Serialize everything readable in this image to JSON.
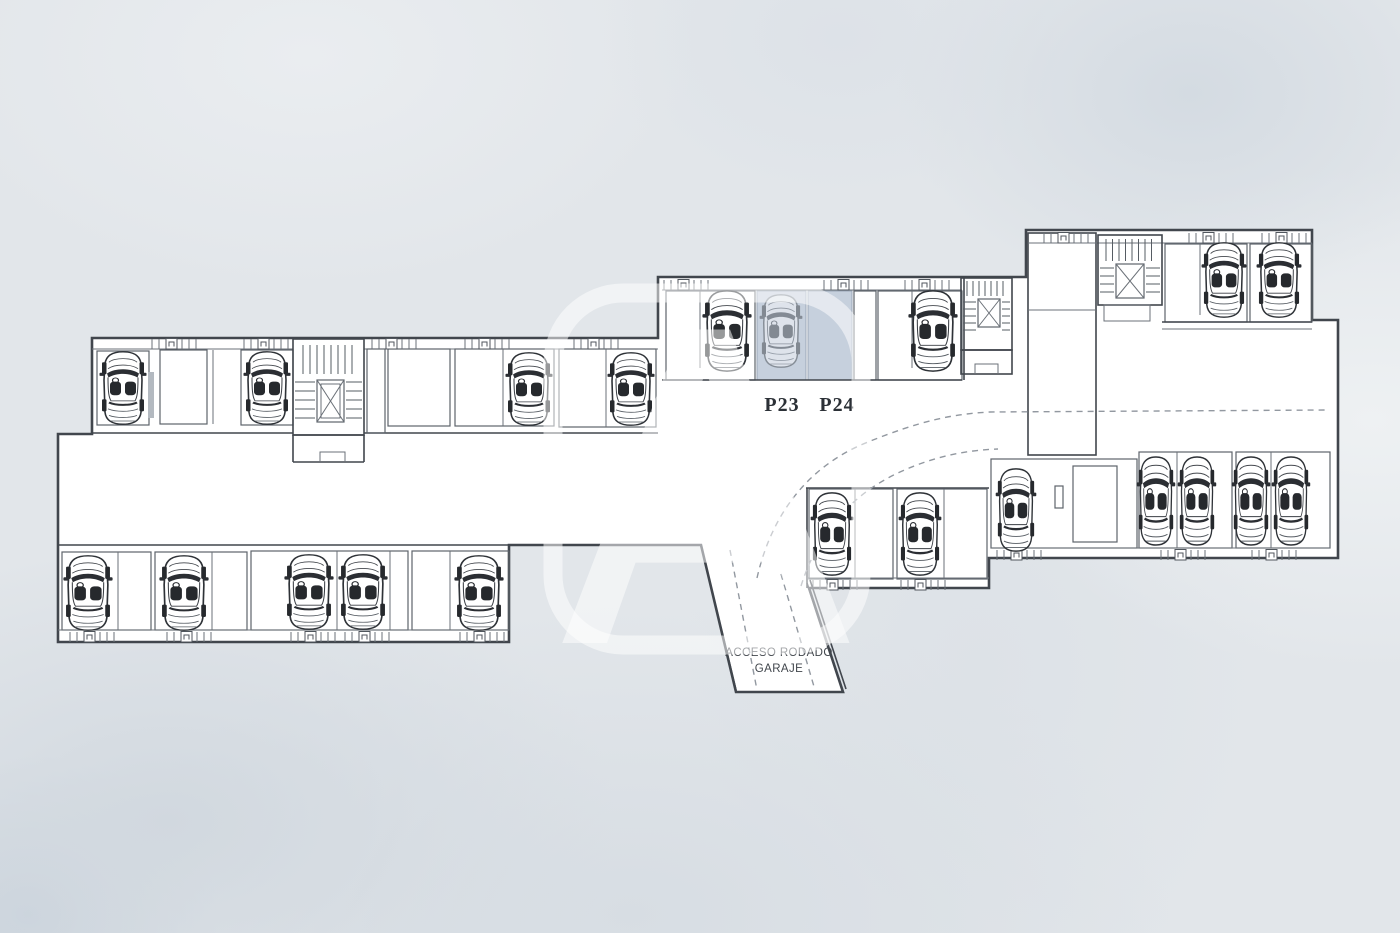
{
  "plan": {
    "stall_labels": {
      "p23": "P23",
      "p24": "P24"
    },
    "ramp": {
      "line1": "ACCESO RODADO",
      "line2": "GARAJE"
    },
    "watermark_letter": "A",
    "colors": {
      "background": "#e2e6ea",
      "wall": "#41464d",
      "highlight": "#c6d0dd",
      "dash": "#9298a0",
      "floor": "#ffffff"
    },
    "icons": {
      "car": "top-view-car-icon",
      "elevator": "elevator-x-icon",
      "stairs": "stair-treads-icon",
      "door": "storage-door-icon"
    },
    "cars": [
      {
        "x": 123,
        "y": 351,
        "w": 44,
        "h": 74
      },
      {
        "x": 267,
        "y": 351,
        "w": 44,
        "h": 74
      },
      {
        "x": 529,
        "y": 352,
        "w": 44,
        "h": 74
      },
      {
        "x": 631,
        "y": 352,
        "w": 44,
        "h": 74
      },
      {
        "x": 727,
        "y": 290,
        "w": 46,
        "h": 82
      },
      {
        "x": 781,
        "y": 294,
        "w": 40,
        "h": 74,
        "ghost": true
      },
      {
        "x": 933,
        "y": 290,
        "w": 46,
        "h": 82
      },
      {
        "x": 1224,
        "y": 242,
        "w": 42,
        "h": 76
      },
      {
        "x": 1279,
        "y": 242,
        "w": 42,
        "h": 76
      },
      {
        "x": 88,
        "y": 555,
        "w": 46,
        "h": 76
      },
      {
        "x": 184,
        "y": 555,
        "w": 46,
        "h": 76
      },
      {
        "x": 309,
        "y": 554,
        "w": 46,
        "h": 76
      },
      {
        "x": 363,
        "y": 554,
        "w": 46,
        "h": 76
      },
      {
        "x": 479,
        "y": 555,
        "w": 46,
        "h": 76
      },
      {
        "x": 832,
        "y": 492,
        "w": 40,
        "h": 84
      },
      {
        "x": 920,
        "y": 492,
        "w": 40,
        "h": 84
      },
      {
        "x": 1016,
        "y": 468,
        "w": 38,
        "h": 84
      },
      {
        "x": 1156,
        "y": 456,
        "w": 36,
        "h": 90
      },
      {
        "x": 1197,
        "y": 456,
        "w": 36,
        "h": 90
      },
      {
        "x": 1251,
        "y": 456,
        "w": 36,
        "h": 90
      },
      {
        "x": 1291,
        "y": 456,
        "w": 36,
        "h": 90
      }
    ]
  }
}
